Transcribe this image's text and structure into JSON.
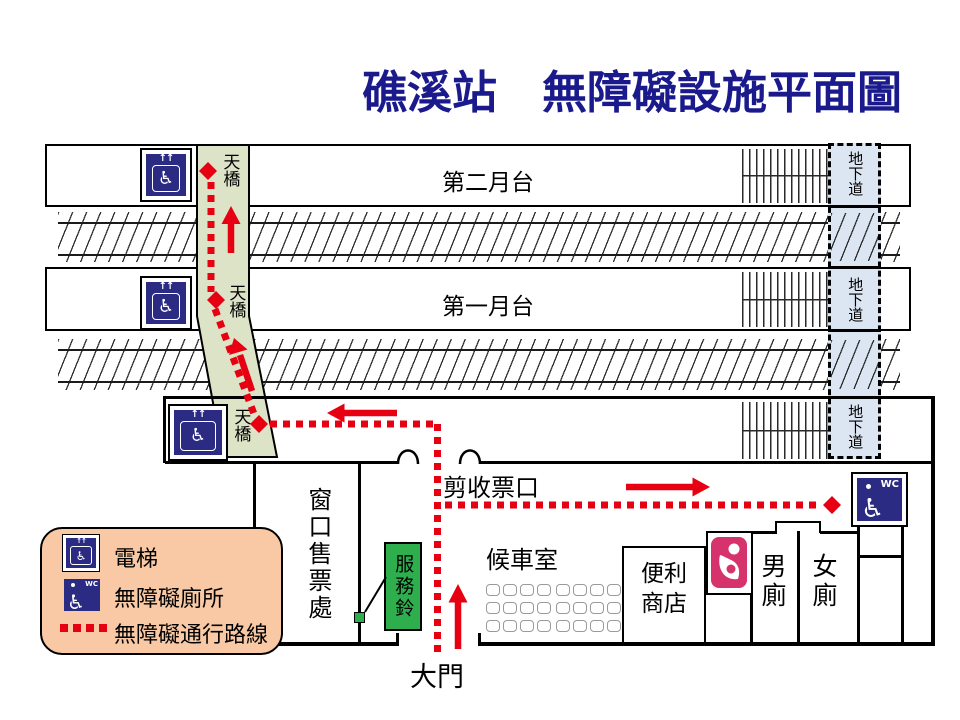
{
  "title": "礁溪站　無障礙設施平面圖",
  "platform2": {
    "label": "第二月台",
    "bridge_label": "天橋",
    "underpass_label": "地下道"
  },
  "platform1": {
    "label": "第一月台",
    "bridge_label": "天橋",
    "underpass_label": "地下道"
  },
  "hall": {
    "bridge_label": "天橋",
    "underpass_label": "地下道",
    "gate_label": "剪收票口"
  },
  "concourse": {
    "ticket_office_label": "窗口售票處",
    "service_bell_label": "服務鈴",
    "waiting_room_label": "候車室",
    "store_label_line1": "便利",
    "store_label_line2": "商店",
    "mens_toilet_label": "男廁",
    "womens_toilet_label": "女廁",
    "entrance_label": "大門",
    "seats_per_group": 12,
    "seat_groups": 2
  },
  "legend": {
    "elevator_label": "電梯",
    "accessible_toilet_label": "無障礙廁所",
    "accessible_route_label": "無障礙通行路線"
  },
  "icons": {
    "wheelchair_glyph": "♿",
    "elevator_arrows_glyph": "↑↑",
    "wc_text": "WC",
    "nursing_icon": "mother-and-baby",
    "route_dot": "red-dotted-line",
    "route_node": "red-diamond"
  },
  "colors": {
    "title_navy": "#1a1a8c",
    "route_red": "#e60012",
    "icon_navy": "#2b2b84",
    "bridge_green": "#dde3c6",
    "underpass_blue": "#dce6f3",
    "legend_peach": "#f8c9a4",
    "bell_green": "#2fae4e",
    "nursing_pink": "#d6336c"
  }
}
